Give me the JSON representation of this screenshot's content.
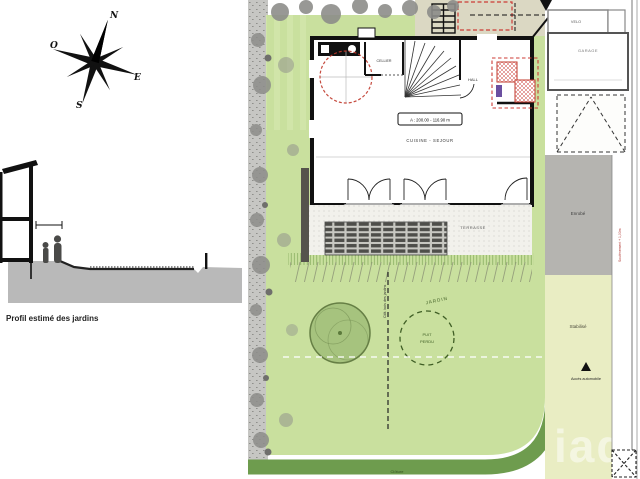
{
  "compass": {
    "n": "N",
    "e": "E",
    "s": "S",
    "o": "O"
  },
  "profile": {
    "caption": "Profil estimé des jardins"
  },
  "plan": {
    "building": {
      "cellier": "CELLIER",
      "hall": "HALL",
      "area_label": "A : 200.00 - 116.90 m",
      "cuisine_sejour": "CUISINE - SEJOUR"
    },
    "terrasse": "TERRASSE",
    "garden": {
      "jardin": "JARDIN",
      "puit_line1": "PUIT",
      "puit_line2": "PERDU",
      "fence_note": "Clôt. bois des jardins"
    },
    "bottom": {
      "cloture": "Clôture"
    },
    "right": {
      "velo": "VELO",
      "garage": "GARAGE",
      "enrobe": "Enrobé",
      "soutenement": "Soutènement + 1,00m",
      "stabilise": "Stabilisé",
      "acces": "Accès automobile"
    },
    "watermark": "iad"
  },
  "colors": {
    "garden_green": "#c9e09e",
    "fence_band_green": "#6e9c4e",
    "enrobe_gray": "#b5b4b0",
    "stabilise_pale": "#e9edc3",
    "beige_strip": "#dbd8c3",
    "modification_red": "#c0392b",
    "tree_green": "#a6c37e"
  }
}
